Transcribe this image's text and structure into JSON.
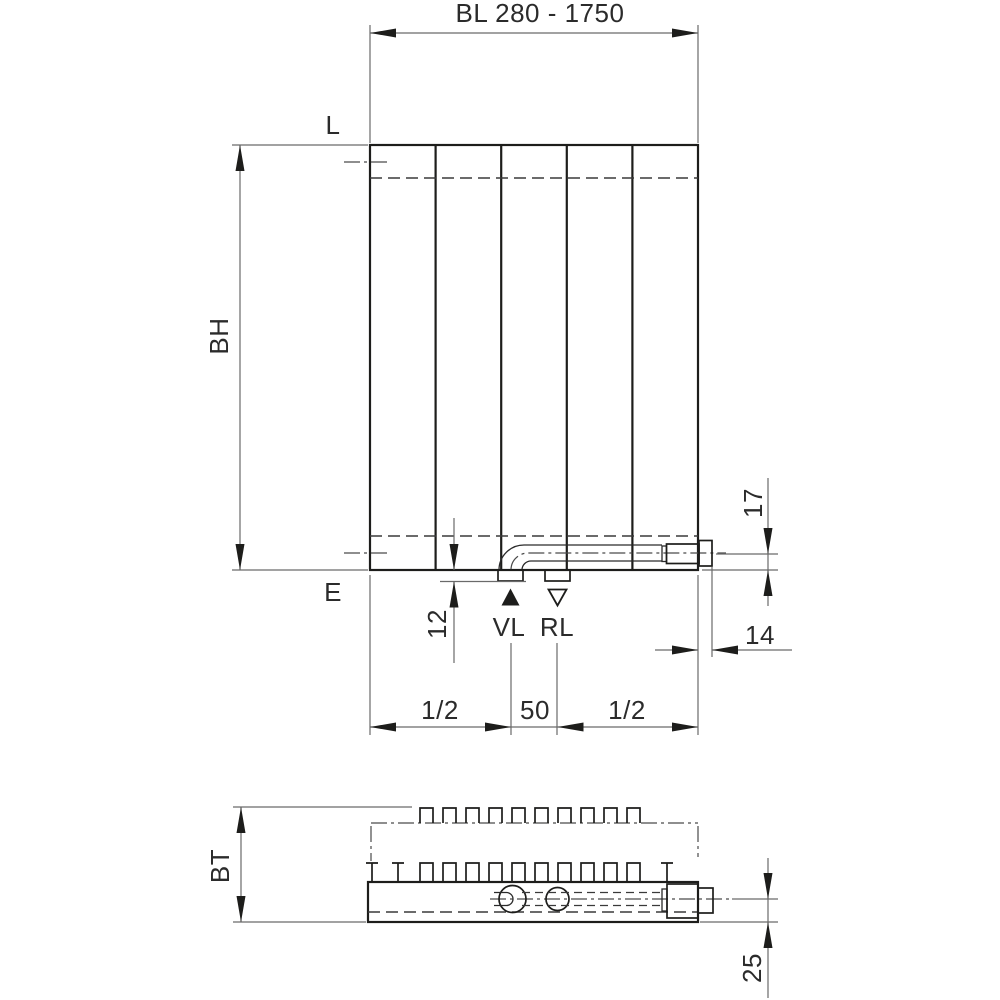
{
  "drawing": {
    "front_view": {
      "length_dim_label": "BL 280 - 1750",
      "top_edge_label": "L",
      "bottom_edge_label": "E",
      "height_dim_label": "BH",
      "stub_depth_dim_label": "12",
      "flow_label": "VL",
      "return_label": "RL",
      "left_half_dim_label": "1/2",
      "connection_spacing_dim_label": "50",
      "right_half_dim_label": "1/2",
      "side_protrusion_dim_label": "14",
      "pipe_offset_dim_label": "17"
    },
    "bottom_view": {
      "depth_dim_label": "BT",
      "pipe_back_offset_dim_label": "25"
    },
    "colors": {
      "background": "#ffffff",
      "object_line": "#1d1d1b",
      "dimension_line": "#6a6a6a",
      "text": "#2b2b2b"
    }
  }
}
